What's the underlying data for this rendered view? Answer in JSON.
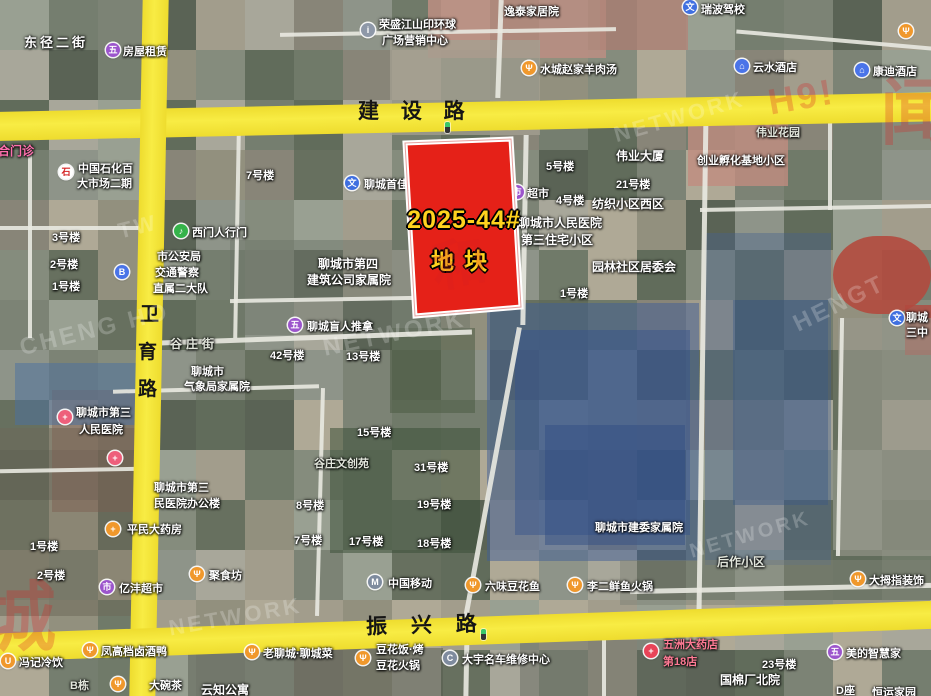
{
  "parcel": {
    "line1": "2025-44#",
    "line2": "地块",
    "fill": "#e52118",
    "text_color": "#ffd21e"
  },
  "roads": {
    "jianshe": "建 设 路",
    "zhenxing": "振 兴 路",
    "weiyu": [
      "卫",
      "育",
      "路"
    ]
  },
  "pois": [
    {
      "n": "rental",
      "i": "marker",
      "x": 113,
      "y": 50,
      "lines": [
        {
          "t": "房屋租赁",
          "x": 123,
          "y": 43
        }
      ]
    },
    {
      "n": "rongsheng-sales-center",
      "i": "info",
      "x": 368,
      "y": 30,
      "lines": [
        {
          "t": "荣盛江山印环球",
          "x": 379,
          "y": 16
        },
        {
          "t": "广场营销中心",
          "x": 382,
          "y": 32
        }
      ]
    },
    {
      "n": "shuicheng-lamb-soup",
      "i": "food",
      "x": 529,
      "y": 68,
      "lines": [
        {
          "t": "水城赵家羊肉汤",
          "x": 540,
          "y": 61
        }
      ]
    },
    {
      "n": "ruibo-driving-school",
      "i": "school",
      "x": 690,
      "y": 7,
      "lines": [
        {
          "t": "瑞波驾校",
          "x": 701,
          "y": 1
        }
      ]
    },
    {
      "n": "yunshui-hotel",
      "i": "hotel",
      "x": 742,
      "y": 66,
      "lines": [
        {
          "t": "云水酒店",
          "x": 753,
          "y": 59
        }
      ]
    },
    {
      "n": "kangdi-hotel",
      "i": "hotel",
      "x": 862,
      "y": 70,
      "lines": [
        {
          "t": "康迪酒店",
          "x": 873,
          "y": 63
        }
      ]
    },
    {
      "n": "corner-poi",
      "i": "food",
      "x": 906,
      "y": 31,
      "lines": []
    },
    {
      "n": "sinopec-market",
      "i": "sinopec",
      "x": 66,
      "y": 172,
      "lines": [
        {
          "t": "中国石化百",
          "x": 78,
          "y": 160
        },
        {
          "t": "大市场二期",
          "x": 77,
          "y": 175
        }
      ]
    },
    {
      "n": "west-gate",
      "i": "gate",
      "x": 181,
      "y": 231,
      "lines": [
        {
          "t": "西门人行门",
          "x": 192,
          "y": 224
        }
      ]
    },
    {
      "n": "bus-stop",
      "i": "bus",
      "x": 122,
      "y": 272,
      "lines": []
    },
    {
      "n": "third-peoples-hospital",
      "i": "cross",
      "x": 65,
      "y": 417,
      "lines": [
        {
          "t": "聊城市第三",
          "x": 76,
          "y": 404
        },
        {
          "t": "人民医院",
          "x": 79,
          "y": 421
        }
      ]
    },
    {
      "n": "hospital-branch",
      "i": "cross",
      "x": 115,
      "y": 458,
      "lines": []
    },
    {
      "n": "pingmin-pharmacy",
      "i": "pharm",
      "x": 113,
      "y": 529,
      "lines": [
        {
          "t": "平民大药房",
          "x": 127,
          "y": 521
        }
      ]
    },
    {
      "n": "yifeng-supermarket",
      "i": "cart",
      "x": 107,
      "y": 587,
      "lines": [
        {
          "t": "亿沣超市",
          "x": 119,
          "y": 580
        }
      ]
    },
    {
      "n": "jushifang-restaurant",
      "i": "food",
      "x": 197,
      "y": 574,
      "lines": [
        {
          "t": "聚食坊",
          "x": 209,
          "y": 567
        }
      ]
    },
    {
      "n": "blind-massage",
      "i": "marker",
      "x": 295,
      "y": 325,
      "lines": [
        {
          "t": "聊城盲人推拿",
          "x": 307,
          "y": 318
        }
      ]
    },
    {
      "n": "china-mobile",
      "i": "mobile",
      "x": 375,
      "y": 582,
      "lines": [
        {
          "t": "中国移动",
          "x": 388,
          "y": 575
        }
      ]
    },
    {
      "n": "douhua-fish",
      "i": "food",
      "x": 473,
      "y": 585,
      "lines": [
        {
          "t": "六味豆花鱼",
          "x": 485,
          "y": 578
        }
      ]
    },
    {
      "n": "lier-fish-hotpot",
      "i": "food",
      "x": 575,
      "y": 585,
      "lines": [
        {
          "t": "李二鲜鱼火锅",
          "x": 587,
          "y": 578
        }
      ]
    },
    {
      "n": "damuzhi-decoration",
      "i": "food",
      "x": 858,
      "y": 579,
      "lines": [
        {
          "t": "大拇指装饰",
          "x": 869,
          "y": 572
        }
      ]
    },
    {
      "n": "fengji-cold-drinks",
      "i": "drink",
      "x": 8,
      "y": 661,
      "lines": [
        {
          "t": "冯记冷饮",
          "x": 19,
          "y": 654
        }
      ]
    },
    {
      "n": "fenggao-duck",
      "i": "food",
      "x": 90,
      "y": 650,
      "lines": [
        {
          "t": "凤高档卤酒鸭",
          "x": 101,
          "y": 643
        }
      ]
    },
    {
      "n": "dawancha-teahouse",
      "i": "food",
      "x": 118,
      "y": 684,
      "lines": [
        {
          "t": "大碗茶",
          "x": 149,
          "y": 677
        }
      ]
    },
    {
      "n": "lao-liaocheng-restaurant",
      "i": "food",
      "x": 252,
      "y": 652,
      "lines": [
        {
          "t": "老聊城·聊城菜",
          "x": 263,
          "y": 645
        }
      ]
    },
    {
      "n": "douhuafan-hotpot",
      "i": "food",
      "x": 363,
      "y": 658,
      "lines": [
        {
          "t": "豆花饭·烤",
          "x": 376,
          "y": 641
        },
        {
          "t": "豆花火锅",
          "x": 376,
          "y": 657
        }
      ]
    },
    {
      "n": "dayu-car-repair",
      "i": "car",
      "x": 450,
      "y": 658,
      "lines": [
        {
          "t": "大宇名车维修中心",
          "x": 462,
          "y": 651
        }
      ]
    },
    {
      "n": "wuzhou-pharmacy",
      "i": "pill",
      "x": 651,
      "y": 651,
      "lines": [
        {
          "t": "五洲大药店",
          "x": 663,
          "y": 636,
          "cls": "rose"
        },
        {
          "t": "第18店",
          "x": 663,
          "y": 653,
          "cls": "rose"
        }
      ]
    },
    {
      "n": "midea-smart-home",
      "i": "marker",
      "x": 835,
      "y": 652,
      "lines": [
        {
          "t": "美的智慧家",
          "x": 846,
          "y": 645
        }
      ]
    },
    {
      "n": "school-east",
      "i": "school",
      "x": 897,
      "y": 318,
      "lines": [
        {
          "t": "聊城",
          "x": 906,
          "y": 309
        },
        {
          "t": "三中",
          "x": 906,
          "y": 324
        }
      ]
    },
    {
      "n": "shoujia-driving-school",
      "i": "school",
      "x": 352,
      "y": 183,
      "lines": [
        {
          "t": "聊城首佳驾校",
          "x": 364,
          "y": 176
        }
      ]
    },
    {
      "n": "chaoshi-supermarket",
      "i": "cart",
      "x": 517,
      "y": 192,
      "lines": [
        {
          "t": "超市",
          "x": 527,
          "y": 185
        }
      ]
    }
  ],
  "labels": [
    {
      "t": "东径二街",
      "x": 24,
      "y": 32,
      "s": 13,
      "ls": 3
    },
    {
      "t": "逸泰家居院",
      "x": 504,
      "y": 3
    },
    {
      "t": "伟业大厦",
      "x": 616,
      "y": 147,
      "s": 12
    },
    {
      "t": "创业孵化基地小区",
      "x": 697,
      "y": 152
    },
    {
      "t": "伟业花园",
      "x": 756,
      "y": 124,
      "cls": "g"
    },
    {
      "t": "5号楼",
      "x": 546,
      "y": 158
    },
    {
      "t": "21号楼",
      "x": 616,
      "y": 176
    },
    {
      "t": "4号楼",
      "x": 556,
      "y": 192
    },
    {
      "t": "纺织小区西区",
      "x": 592,
      "y": 195,
      "s": 12
    },
    {
      "t": "7号楼",
      "x": 246,
      "y": 167
    },
    {
      "t": "3号楼",
      "x": 52,
      "y": 229
    },
    {
      "t": "2号楼",
      "x": 50,
      "y": 256
    },
    {
      "t": "1号楼",
      "x": 52,
      "y": 278
    },
    {
      "t": "聊城市人民医院",
      "x": 518,
      "y": 214,
      "s": 12
    },
    {
      "t": "第三住宅小区",
      "x": 521,
      "y": 231,
      "s": 12
    },
    {
      "t": "园林社区居委会",
      "x": 592,
      "y": 258,
      "s": 12
    },
    {
      "t": "1号楼",
      "x": 560,
      "y": 285
    },
    {
      "t": "市公安局",
      "x": 157,
      "y": 248
    },
    {
      "t": "交通警察",
      "x": 155,
      "y": 264
    },
    {
      "t": "直属二大队",
      "x": 153,
      "y": 280
    },
    {
      "t": "聊城市第四",
      "x": 318,
      "y": 255,
      "s": 12
    },
    {
      "t": "建筑公司家属院",
      "x": 307,
      "y": 271,
      "s": 12
    },
    {
      "t": "谷庄街",
      "x": 170,
      "y": 335,
      "cls": "g",
      "s": 12,
      "ls": 4
    },
    {
      "t": "聊城市",
      "x": 191,
      "y": 363
    },
    {
      "t": "气象局家属院",
      "x": 184,
      "y": 378
    },
    {
      "t": "42号楼",
      "x": 270,
      "y": 347
    },
    {
      "t": "13号楼",
      "x": 346,
      "y": 348
    },
    {
      "t": "15号楼",
      "x": 357,
      "y": 424
    },
    {
      "t": "谷庄文创苑",
      "x": 314,
      "y": 455,
      "cls": "g"
    },
    {
      "t": "31号楼",
      "x": 414,
      "y": 459
    },
    {
      "t": "19号楼",
      "x": 417,
      "y": 496
    },
    {
      "t": "8号楼",
      "x": 296,
      "y": 497
    },
    {
      "t": "7号楼",
      "x": 294,
      "y": 532
    },
    {
      "t": "17号楼",
      "x": 349,
      "y": 533
    },
    {
      "t": "18号楼",
      "x": 417,
      "y": 535
    },
    {
      "t": "聊城市第三",
      "x": 154,
      "y": 479
    },
    {
      "t": "民医院办公楼",
      "x": 154,
      "y": 495
    },
    {
      "t": "聊城市建委家属院",
      "x": 595,
      "y": 519
    },
    {
      "t": "后作小区",
      "x": 717,
      "y": 553,
      "cls": "g",
      "s": 12
    },
    {
      "t": "1号楼",
      "x": 30,
      "y": 538
    },
    {
      "t": "2号楼",
      "x": 37,
      "y": 567
    },
    {
      "t": "B栋",
      "x": 70,
      "y": 677,
      "cls": "g"
    },
    {
      "t": "云知公寓",
      "x": 201,
      "y": 681,
      "s": 12
    },
    {
      "t": "23号楼",
      "x": 762,
      "y": 656
    },
    {
      "t": "国棉厂北院",
      "x": 720,
      "y": 671,
      "s": 12
    },
    {
      "t": "D座",
      "x": 836,
      "y": 682
    },
    {
      "t": "恒运家园",
      "x": 872,
      "y": 684
    },
    {
      "t": "联合门诊",
      "x": -14,
      "y": 142,
      "cls": "pink",
      "s": 12
    }
  ],
  "traffic_lights": [
    {
      "x": 445,
      "y": 122
    },
    {
      "x": 481,
      "y": 629
    }
  ],
  "watermarks": [
    {
      "t": "CHENG HO",
      "x": 18,
      "y": 316,
      "r": -14,
      "c": "white",
      "s": 24
    },
    {
      "t": "NETWORK",
      "x": 322,
      "y": 320,
      "r": -12,
      "c": "white",
      "s": 24
    },
    {
      "t": "NETWORK",
      "x": 612,
      "y": 104,
      "r": -16,
      "c": "white",
      "s": 22
    },
    {
      "t": "HENGT",
      "x": 790,
      "y": 290,
      "r": -26,
      "c": "white",
      "s": 24
    },
    {
      "t": "NETWORK",
      "x": 168,
      "y": 604,
      "r": -10,
      "c": "white",
      "s": 22
    },
    {
      "t": "NETWORK",
      "x": 688,
      "y": 524,
      "r": -16,
      "c": "white",
      "s": 20
    },
    {
      "t": "TW",
      "x": 118,
      "y": 214,
      "r": -14,
      "c": "white",
      "s": 22
    },
    {
      "t": "H9!",
      "x": 768,
      "y": 76,
      "r": -10,
      "c": "red",
      "s": 36
    },
    {
      "t": "闻",
      "x": 880,
      "y": 54,
      "r": 0,
      "c": "red",
      "s": 72
    },
    {
      "t": "城",
      "x": -20,
      "y": 556,
      "r": 0,
      "c": "red",
      "s": 76
    },
    {
      "t": "和",
      "x": 432,
      "y": 220,
      "r": -8,
      "c": "red",
      "s": 54
    }
  ]
}
